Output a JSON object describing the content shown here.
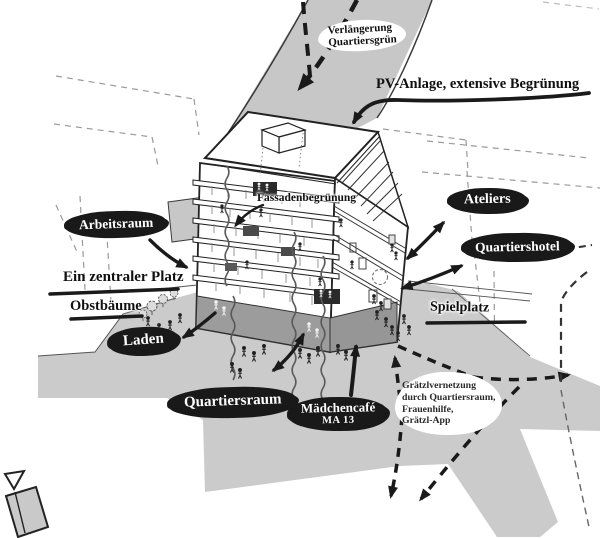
{
  "diagram_labels": {
    "verlaengerung": {
      "line1": "Verlängerung",
      "line2": "Quartiersgrün"
    },
    "pv_anlage": "PV-Anlage, extensive Begrünung",
    "fassadenbegruenung": "Fassadenbegrünung",
    "arbeitsraum": "Arbeitsraum",
    "ein_zentraler_platz": "Ein zentraler Platz",
    "obstbaeume": "Obstbäume",
    "laden": "Laden",
    "ateliers": "Ateliers",
    "quartiershotel": "Quartiershotel",
    "spielplatz": "Spielplatz",
    "quartiersraum": "Quartiersraum",
    "maedchencafe": {
      "line1": "Mädchencafé",
      "line2": "MA 13"
    },
    "graetzlvernetzung": {
      "line1": "Grätzlvernetzung",
      "line2": "durch Quartiersraum,",
      "line3": "Frauenhilfe,",
      "line4": "Grätzl-App"
    }
  },
  "colors": {
    "ink": "#1a1a1a",
    "blob-bg": "#191919",
    "blob-text": "#ffffff",
    "band-gray": "#c7c7c7",
    "plaza-gray": "#cbcbcb",
    "base-gray": "#9c9c9c",
    "context-dash": "#9a9a9a",
    "paper": "#ffffff"
  }
}
